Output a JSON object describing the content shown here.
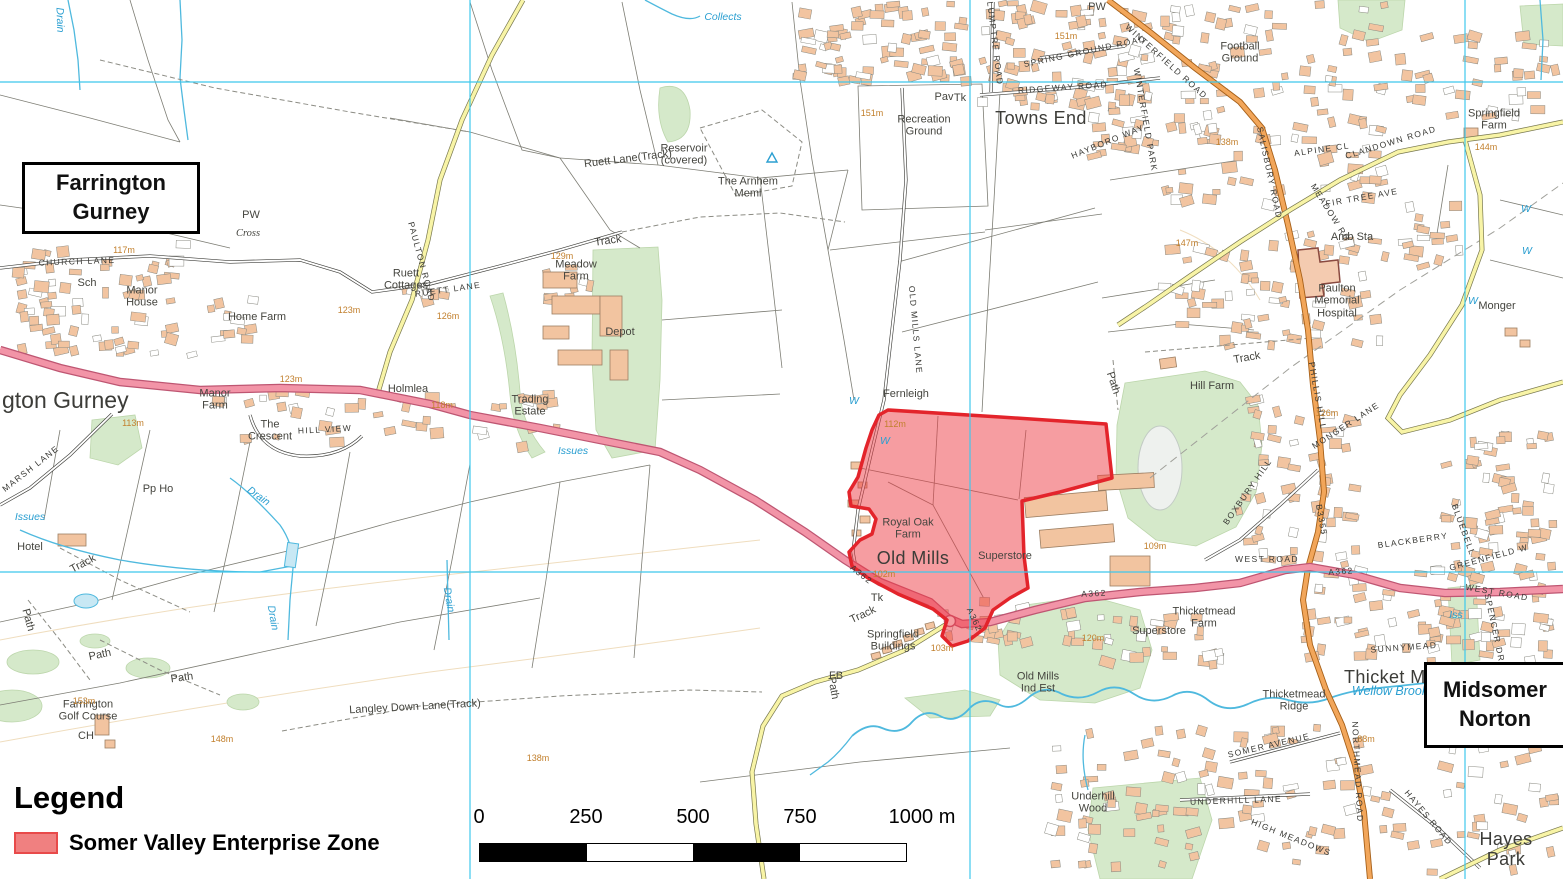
{
  "map": {
    "title_boxes": [
      {
        "id": "farrington",
        "text": "Farrington\nGurney"
      },
      {
        "id": "midsomer",
        "text": "Midsomer\nNorton"
      }
    ],
    "zone": {
      "label": "Somer Valley Enterprise Zone",
      "fill": "#EE3B43",
      "fill_opacity": 0.5,
      "stroke": "#E3242B"
    },
    "grid": {
      "vlines": [
        470,
        970,
        1465
      ],
      "hlines": [
        82,
        572
      ],
      "color": "#3FC8EC"
    },
    "colors": {
      "a_road": "#F294A7",
      "b_road": "#F2A65A",
      "minor_road": "#F8F4A6",
      "woodland": "#D5E9CA",
      "water": "#4FB9DE",
      "building": "#F2C4A0",
      "contour": "#C2802E"
    },
    "labels": [
      {
        "t": "Towns End",
        "x": 1041,
        "y": 118,
        "c": "pL"
      },
      {
        "t": "Old Mills",
        "x": 913,
        "y": 558,
        "c": "pL"
      },
      {
        "t": "Thicket Me",
        "x": 1390,
        "y": 677,
        "c": "pL"
      },
      {
        "t": "Hayes Park",
        "x": 1506,
        "y": 849,
        "c": "pL"
      },
      {
        "t": "gton Gurney",
        "x": 2,
        "y": 401,
        "c": "big",
        "a": "l"
      },
      {
        "t": "Recreation\nGround",
        "x": 924,
        "y": 126
      },
      {
        "t": "Pav",
        "x": 944,
        "y": 97
      },
      {
        "t": "Football\nGround",
        "x": 1240,
        "y": 53
      },
      {
        "t": "Springfield\nFarm",
        "x": 1494,
        "y": 120
      },
      {
        "t": "Amb Sta",
        "x": 1352,
        "y": 237
      },
      {
        "t": "Paulton\nMemorial\nHospital",
        "x": 1337,
        "y": 301
      },
      {
        "t": "Monger",
        "x": 1497,
        "y": 306
      },
      {
        "t": "Hill Farm",
        "x": 1212,
        "y": 386
      },
      {
        "t": "Reservoir\n(covered)",
        "x": 684,
        "y": 155
      },
      {
        "t": "The Arnhem\nMeml",
        "x": 748,
        "y": 188
      },
      {
        "t": "Ruett\nCottages",
        "x": 406,
        "y": 280
      },
      {
        "t": "Meadow\nFarm",
        "x": 576,
        "y": 271
      },
      {
        "t": "Depot",
        "x": 620,
        "y": 332
      },
      {
        "t": "Trading\nEstate",
        "x": 530,
        "y": 406
      },
      {
        "t": "Holmlea",
        "x": 408,
        "y": 389
      },
      {
        "t": "Manor\nHouse",
        "x": 142,
        "y": 297
      },
      {
        "t": "Home Farm",
        "x": 257,
        "y": 317
      },
      {
        "t": "Manor\nFarm",
        "x": 215,
        "y": 400
      },
      {
        "t": "The\nCrescent",
        "x": 270,
        "y": 431
      },
      {
        "t": "Farrington\nGolf Course",
        "x": 88,
        "y": 711
      },
      {
        "t": "Fernleigh",
        "x": 906,
        "y": 394
      },
      {
        "t": "Royal Oak\nFarm",
        "x": 908,
        "y": 529
      },
      {
        "t": "Superstore",
        "x": 1005,
        "y": 556
      },
      {
        "t": "Superstore",
        "x": 1159,
        "y": 631
      },
      {
        "t": "Thicketmead\nFarm",
        "x": 1204,
        "y": 618
      },
      {
        "t": "Old Mills\nInd Est",
        "x": 1038,
        "y": 683
      },
      {
        "t": "Springfield\nBuildings",
        "x": 893,
        "y": 641
      },
      {
        "t": "Underhill\nWood",
        "x": 1093,
        "y": 803
      },
      {
        "t": "Thicketmead\nRidge",
        "x": 1294,
        "y": 701
      },
      {
        "t": "Hotel",
        "x": 30,
        "y": 547
      },
      {
        "t": "Sch",
        "x": 87,
        "y": 283
      },
      {
        "t": "PW",
        "x": 251,
        "y": 215
      },
      {
        "t": "PW",
        "x": 1097,
        "y": 7
      },
      {
        "t": "Cross",
        "x": 248,
        "y": 234,
        "c": "it"
      },
      {
        "t": "CH",
        "x": 86,
        "y": 736
      },
      {
        "t": "Pp Ho",
        "x": 158,
        "y": 489
      },
      {
        "t": "FB",
        "x": 836,
        "y": 676
      },
      {
        "t": "Tk",
        "x": 960,
        "y": 98
      },
      {
        "t": "Tk",
        "x": 877,
        "y": 598
      },
      {
        "t": "Langley Down Lane(Track)",
        "x": 415,
        "y": 707,
        "r": -3
      },
      {
        "t": "Ruett Lane(Track)",
        "x": 628,
        "y": 159,
        "r": -7
      },
      {
        "t": "Track",
        "x": 608,
        "y": 241,
        "r": -8
      },
      {
        "t": "Track",
        "x": 1247,
        "y": 358,
        "r": -10
      },
      {
        "t": "Track",
        "x": 83,
        "y": 564,
        "r": -28
      },
      {
        "t": "Track",
        "x": 863,
        "y": 615,
        "r": -25
      },
      {
        "t": "Path",
        "x": 28,
        "y": 620,
        "r": 75
      },
      {
        "t": "Path",
        "x": 100,
        "y": 655,
        "r": -12
      },
      {
        "t": "Path",
        "x": 182,
        "y": 678,
        "r": -8
      },
      {
        "t": "Path",
        "x": 1113,
        "y": 383,
        "r": 72
      },
      {
        "t": "Path",
        "x": 833,
        "y": 688,
        "r": 80
      },
      {
        "t": "CHURCH LANE",
        "x": 77,
        "y": 262,
        "c": "rd",
        "r": -2
      },
      {
        "t": "MARSH LANE",
        "x": 31,
        "y": 469,
        "c": "rd",
        "r": -38
      },
      {
        "t": "RUETT LANE",
        "x": 448,
        "y": 290,
        "c": "rd",
        "r": -8
      },
      {
        "t": "PAULTON ROAD",
        "x": 421,
        "y": 262,
        "c": "rd",
        "r": 75
      },
      {
        "t": "PLUMPTRE ROAD",
        "x": 994,
        "y": 40,
        "c": "rd",
        "r": 83
      },
      {
        "t": "SPRING GROUND ROAD",
        "x": 1085,
        "y": 52,
        "c": "rd",
        "r": -12
      },
      {
        "t": "RIDGEWAY ROAD",
        "x": 1063,
        "y": 88,
        "c": "rd",
        "r": -4
      },
      {
        "t": "WINTERFIELD ROAD",
        "x": 1166,
        "y": 62,
        "c": "rd",
        "r": 42
      },
      {
        "t": "HAYBORO WAY",
        "x": 1108,
        "y": 142,
        "c": "rd",
        "r": -22
      },
      {
        "t": "WINTERFIELD PARK",
        "x": 1145,
        "y": 120,
        "c": "rd",
        "r": 80
      },
      {
        "t": "SALISBURY ROAD",
        "x": 1269,
        "y": 173,
        "c": "rd",
        "r": 78
      },
      {
        "t": "CLANDOWN ROAD",
        "x": 1391,
        "y": 143,
        "c": "rd",
        "r": -17
      },
      {
        "t": "ALPINE CL",
        "x": 1322,
        "y": 150,
        "c": "rd",
        "r": -8
      },
      {
        "t": "FIR TREE AVE",
        "x": 1362,
        "y": 198,
        "c": "rd",
        "r": -10
      },
      {
        "t": "MEADOW RD",
        "x": 1330,
        "y": 213,
        "c": "rd",
        "r": 58
      },
      {
        "t": "WEST ROAD",
        "x": 1267,
        "y": 560,
        "c": "rd"
      },
      {
        "t": "WEST ROAD",
        "x": 1497,
        "y": 593,
        "c": "rd",
        "r": 10
      },
      {
        "t": "PHILLIS HILL",
        "x": 1317,
        "y": 396,
        "c": "rd",
        "r": 80
      },
      {
        "t": "MONGER LANE",
        "x": 1346,
        "y": 426,
        "c": "rd",
        "r": -33
      },
      {
        "t": "BOXBURY HILL",
        "x": 1248,
        "y": 492,
        "c": "rd",
        "r": -55
      },
      {
        "t": "B3355",
        "x": 1321,
        "y": 520,
        "c": "rd",
        "r": 80
      },
      {
        "t": "SUNNYMEAD",
        "x": 1404,
        "y": 648,
        "c": "rd",
        "r": -4
      },
      {
        "t": "BLACKBERRY",
        "x": 1413,
        "y": 541,
        "c": "rd",
        "r": -8
      },
      {
        "t": "BLUEBELL",
        "x": 1463,
        "y": 530,
        "c": "rd",
        "r": 70
      },
      {
        "t": "GREENFIELD W",
        "x": 1489,
        "y": 558,
        "c": "rd",
        "r": -15
      },
      {
        "t": "SOMER AVENUE",
        "x": 1269,
        "y": 746,
        "c": "rd",
        "r": -13
      },
      {
        "t": "UNDERHILL LANE",
        "x": 1236,
        "y": 801,
        "c": "rd",
        "r": -2
      },
      {
        "t": "HIGH MEADOWS",
        "x": 1291,
        "y": 838,
        "c": "rd",
        "r": 22
      },
      {
        "t": "NORTHMEAD ROAD",
        "x": 1357,
        "y": 772,
        "c": "rd",
        "r": 87
      },
      {
        "t": "HAYES ROAD",
        "x": 1428,
        "y": 818,
        "c": "rd",
        "r": 50
      },
      {
        "t": "SPENCER DR",
        "x": 1494,
        "y": 628,
        "c": "rd",
        "r": 78
      },
      {
        "t": "HILL VIEW",
        "x": 325,
        "y": 430,
        "c": "rd",
        "r": -3
      },
      {
        "t": "OLD MILLS LANE",
        "x": 915,
        "y": 330,
        "c": "rd",
        "r": 85
      },
      {
        "t": "A362",
        "x": 861,
        "y": 575,
        "c": "rd",
        "r": 38
      },
      {
        "t": "A362",
        "x": 974,
        "y": 620,
        "c": "rd",
        "r": 65
      },
      {
        "t": "A362",
        "x": 1094,
        "y": 594,
        "c": "rd",
        "r": -3
      },
      {
        "t": "A362",
        "x": 1341,
        "y": 572,
        "c": "rd",
        "r": -4
      },
      {
        "t": "151m",
        "x": 1066,
        "y": 36,
        "c": "el"
      },
      {
        "t": "151m",
        "x": 872,
        "y": 113,
        "c": "el"
      },
      {
        "t": "147m",
        "x": 1187,
        "y": 243,
        "c": "el"
      },
      {
        "t": "138m",
        "x": 1227,
        "y": 142,
        "c": "el"
      },
      {
        "t": "144m",
        "x": 1486,
        "y": 147,
        "c": "el"
      },
      {
        "t": "126m",
        "x": 1327,
        "y": 413,
        "c": "el"
      },
      {
        "t": "117m",
        "x": 124,
        "y": 250,
        "c": "el"
      },
      {
        "t": "123m",
        "x": 349,
        "y": 310,
        "c": "el"
      },
      {
        "t": "123m",
        "x": 291,
        "y": 379,
        "c": "el"
      },
      {
        "t": "129m",
        "x": 562,
        "y": 256,
        "c": "el"
      },
      {
        "t": "126m",
        "x": 448,
        "y": 316,
        "c": "el"
      },
      {
        "t": "118m",
        "x": 442,
        "y": 405,
        "c": "el"
      },
      {
        "t": "113m",
        "x": 133,
        "y": 423,
        "c": "el"
      },
      {
        "t": "112m",
        "x": 895,
        "y": 424,
        "c": "el"
      },
      {
        "t": "102m",
        "x": 884,
        "y": 574,
        "c": "el"
      },
      {
        "t": "103m",
        "x": 942,
        "y": 648,
        "c": "el"
      },
      {
        "t": "120m",
        "x": 1093,
        "y": 638,
        "c": "el"
      },
      {
        "t": "109m",
        "x": 1155,
        "y": 546,
        "c": "el"
      },
      {
        "t": "148m",
        "x": 222,
        "y": 739,
        "c": "el"
      },
      {
        "t": "153m",
        "x": 84,
        "y": 701,
        "c": "el"
      },
      {
        "t": "138m",
        "x": 538,
        "y": 758,
        "c": "el"
      },
      {
        "t": "88m",
        "x": 1366,
        "y": 739,
        "c": "el"
      },
      {
        "t": "Collects",
        "x": 723,
        "y": 18,
        "c": "wt"
      },
      {
        "t": "Drain",
        "x": 59,
        "y": 20,
        "c": "wt",
        "r": 88
      },
      {
        "t": "Issues",
        "x": 573,
        "y": 452,
        "c": "wt"
      },
      {
        "t": "Issues",
        "x": 30,
        "y": 518,
        "c": "wt"
      },
      {
        "t": "Drain",
        "x": 258,
        "y": 497,
        "c": "wt",
        "r": 35
      },
      {
        "t": "Drain",
        "x": 272,
        "y": 618,
        "c": "wt",
        "r": 80
      },
      {
        "t": "Drain",
        "x": 448,
        "y": 600,
        "c": "wt",
        "r": 80
      },
      {
        "t": "Wellow Brook",
        "x": 1390,
        "y": 691,
        "c": "wtb"
      },
      {
        "t": "Iss",
        "x": 1456,
        "y": 616,
        "c": "wt"
      },
      {
        "t": "W",
        "x": 854,
        "y": 402,
        "c": "wt"
      },
      {
        "t": "W",
        "x": 885,
        "y": 442,
        "c": "wt"
      },
      {
        "t": "W",
        "x": 1526,
        "y": 210,
        "c": "wt"
      },
      {
        "t": "W",
        "x": 1527,
        "y": 252,
        "c": "wt"
      },
      {
        "t": "W",
        "x": 1473,
        "y": 302,
        "c": "wt"
      }
    ],
    "building_clusters": [
      {
        "x": 792,
        "y": 0,
        "w": 180,
        "h": 90,
        "n": 70
      },
      {
        "x": 975,
        "y": 0,
        "w": 185,
        "h": 110,
        "n": 80
      },
      {
        "x": 1160,
        "y": 0,
        "w": 230,
        "h": 210,
        "n": 110
      },
      {
        "x": 1395,
        "y": 28,
        "w": 165,
        "h": 95,
        "n": 35
      },
      {
        "x": 1155,
        "y": 225,
        "w": 230,
        "h": 125,
        "n": 75
      },
      {
        "x": 0,
        "y": 238,
        "w": 200,
        "h": 120,
        "n": 70
      },
      {
        "x": 200,
        "y": 390,
        "w": 360,
        "h": 62,
        "n": 45
      },
      {
        "x": 1235,
        "y": 385,
        "w": 130,
        "h": 180,
        "n": 55
      },
      {
        "x": 1300,
        "y": 560,
        "w": 260,
        "h": 120,
        "n": 90
      },
      {
        "x": 1440,
        "y": 430,
        "w": 120,
        "h": 130,
        "n": 55
      },
      {
        "x": 1045,
        "y": 722,
        "w": 515,
        "h": 155,
        "n": 130
      },
      {
        "x": 195,
        "y": 295,
        "w": 80,
        "h": 50,
        "n": 12
      },
      {
        "x": 390,
        "y": 282,
        "w": 60,
        "h": 25,
        "n": 8
      },
      {
        "x": 540,
        "y": 262,
        "w": 70,
        "h": 45,
        "n": 10
      },
      {
        "x": 1380,
        "y": 190,
        "w": 90,
        "h": 80,
        "n": 18
      },
      {
        "x": 1085,
        "y": 90,
        "w": 75,
        "h": 70,
        "n": 25
      },
      {
        "x": 1090,
        "y": 608,
        "w": 150,
        "h": 62,
        "n": 28
      },
      {
        "x": 930,
        "y": 596,
        "w": 160,
        "h": 62,
        "n": 26
      }
    ]
  },
  "legend": {
    "title": "Legend",
    "items": [
      {
        "label": "Somer Valley Enterprise Zone",
        "swatch_fill": "#F08080",
        "swatch_border": "#E84A4A"
      }
    ]
  },
  "scalebar": {
    "tick_labels": [
      "0",
      "250",
      "500",
      "750",
      "1000 m"
    ],
    "tick_centers": [
      479,
      586,
      693,
      800,
      922
    ],
    "labels_top": 806,
    "bar": {
      "x": 479,
      "y": 843,
      "width": 428,
      "height": 19,
      "segments": [
        "#000000",
        "#ffffff",
        "#000000",
        "#ffffff"
      ]
    }
  }
}
